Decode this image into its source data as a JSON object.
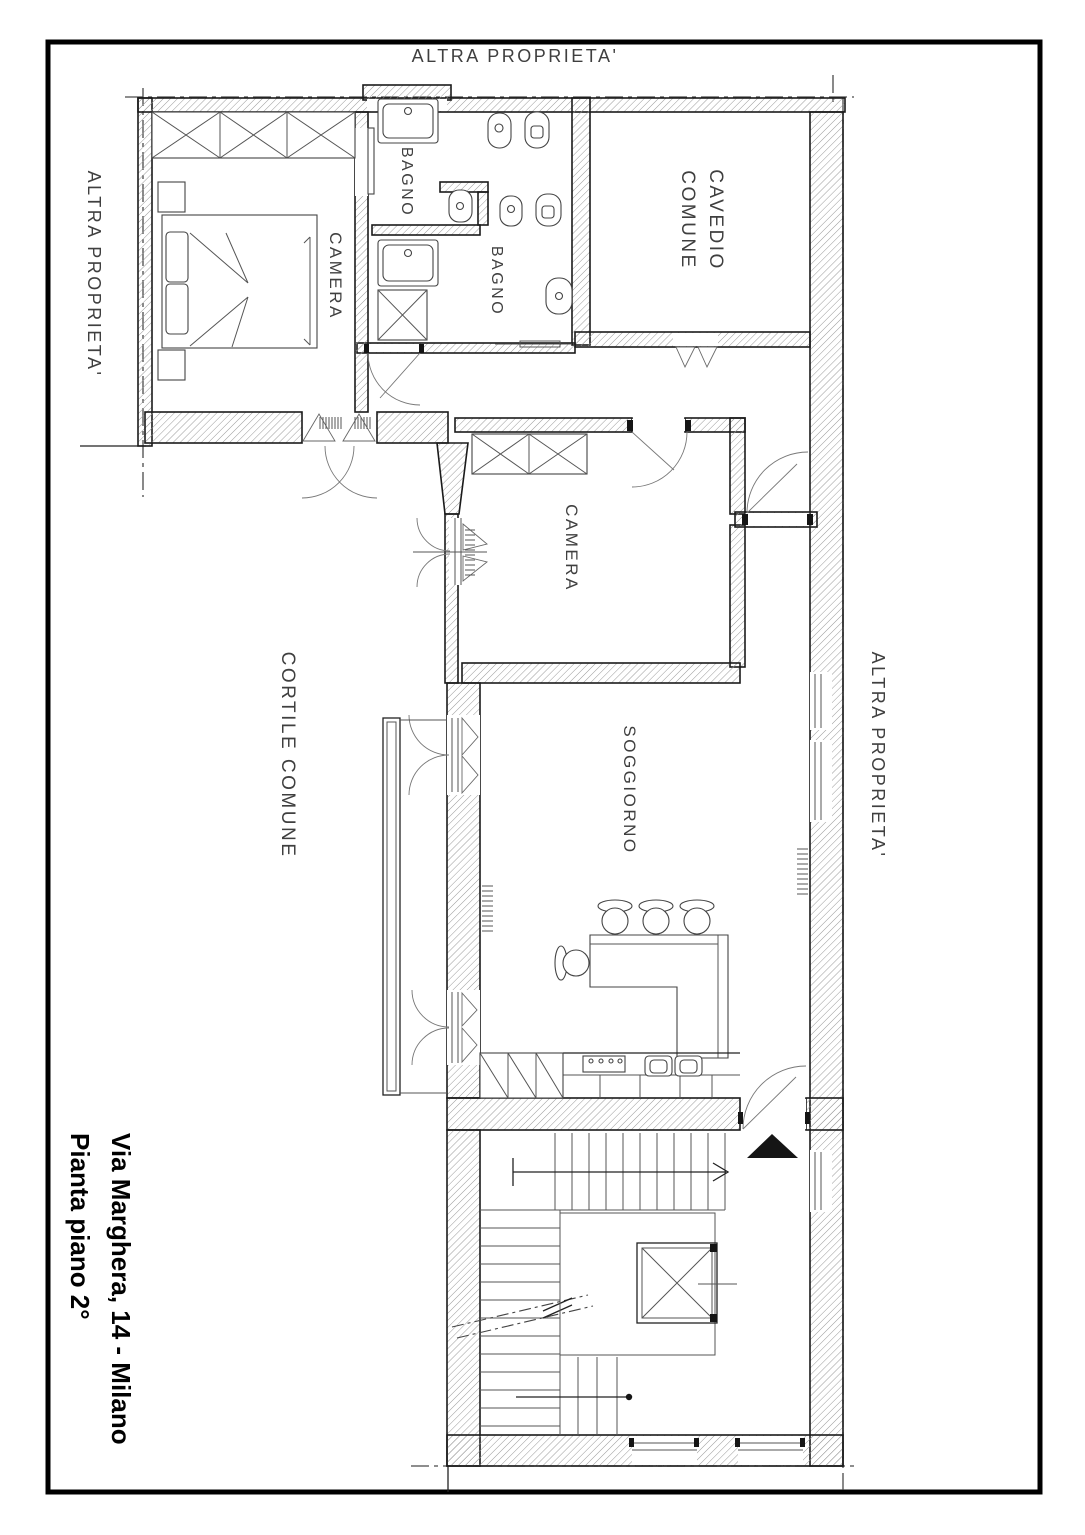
{
  "title": {
    "line1": "Via Marghera, 14 - Milano",
    "line2": "Pianta piano 2°"
  },
  "boundaries": {
    "top": "ALTRA  PROPRIETA'",
    "left": "ALTRA  PROPRIETA'",
    "right": "ALTRA  PROPRIETA'"
  },
  "rooms": {
    "camera_nord": "CAMERA",
    "bagno_1": "BAGNO",
    "bagno_2": "BAGNO",
    "cavedio_line1": "CAVEDIO",
    "cavedio_line2": "COMUNE",
    "camera_centro": "CAMERA",
    "soggiorno": "SOGGIORNO",
    "cortile": "CORTILE  COMUNE"
  },
  "colors": {
    "paper": "#ffffff",
    "wall_outline": "#1b1b1b",
    "hatch": "#9a9a9a",
    "boundary_dash": "#4a4a4a",
    "label_text": "#3f3f3f",
    "title_text": "#000000"
  }
}
